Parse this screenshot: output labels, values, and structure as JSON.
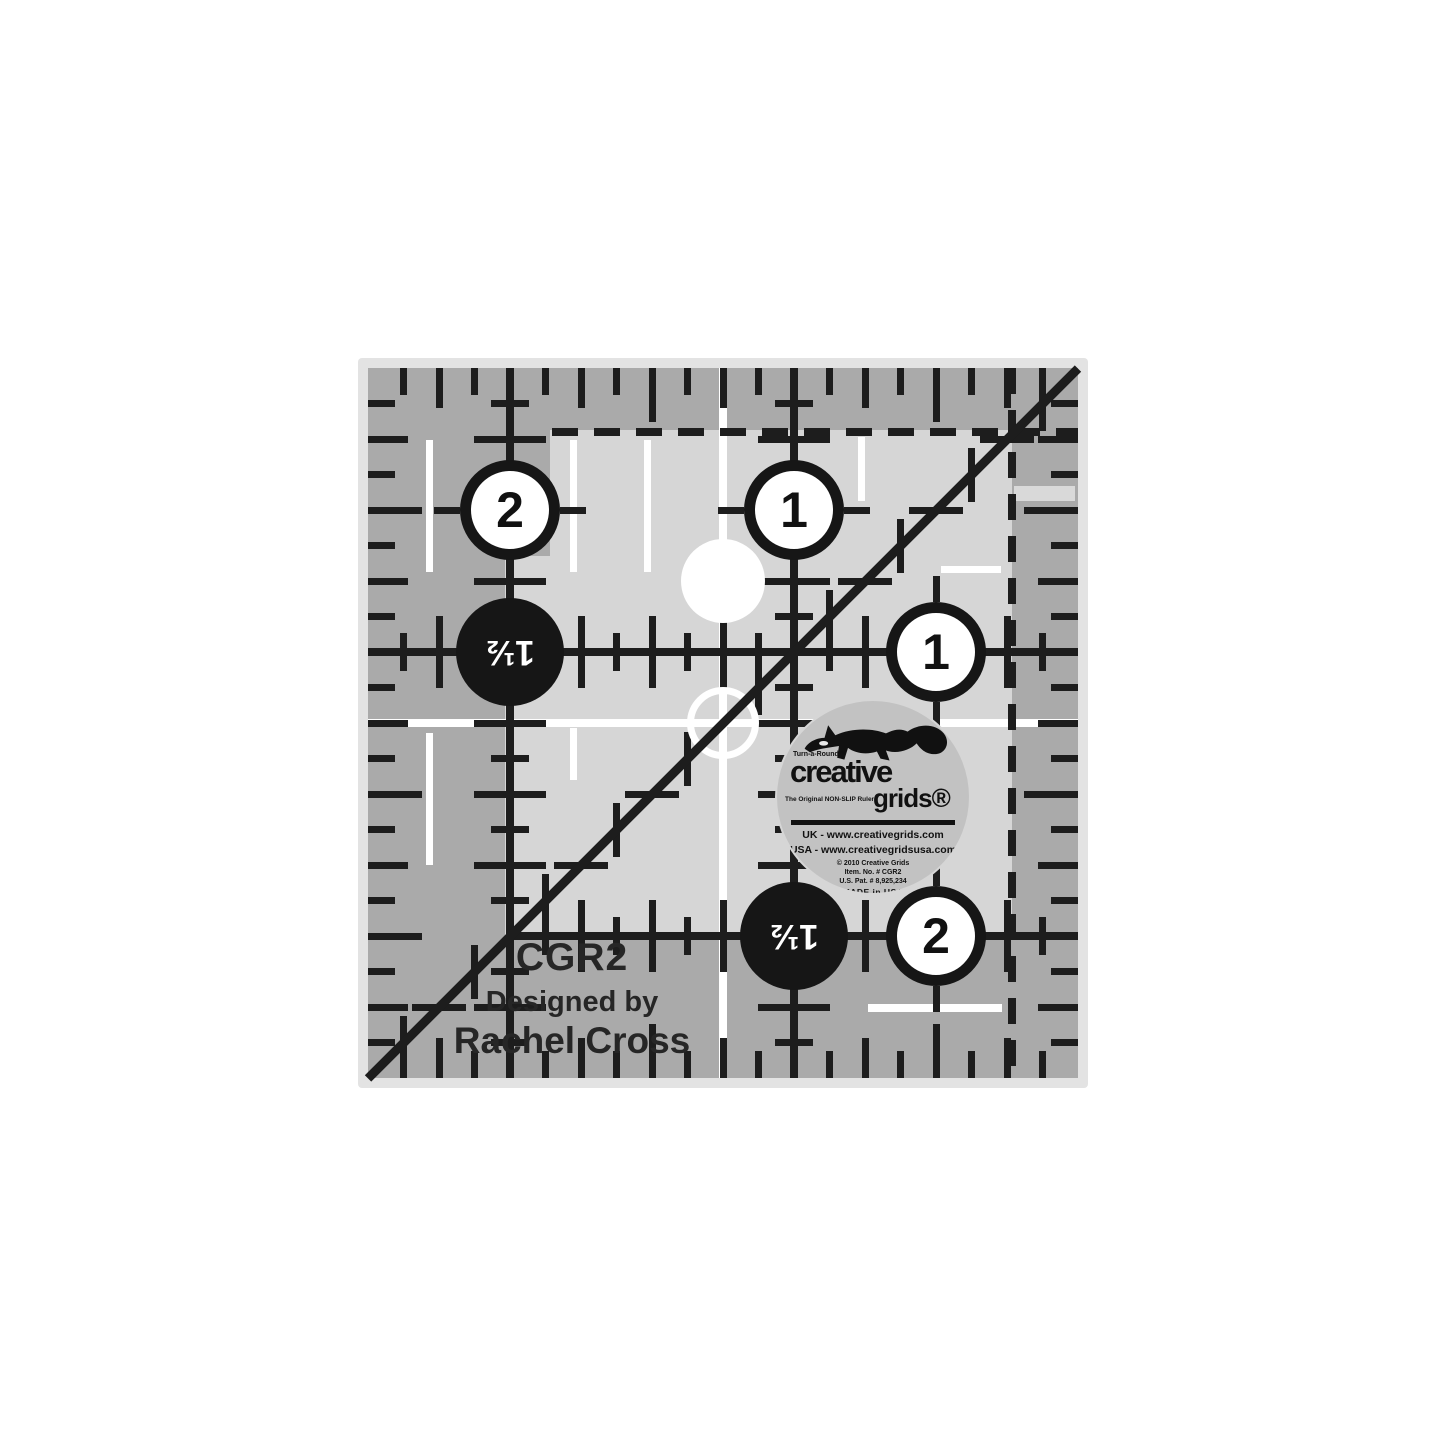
{
  "product": {
    "model": "CGR2",
    "designed_by_label": "Designed by",
    "designer": "Rachel Cross"
  },
  "ruler_markings": {
    "circles": [
      {
        "value": "2",
        "style": "white",
        "orientation": "upright"
      },
      {
        "value": "1",
        "style": "white",
        "orientation": "upright"
      },
      {
        "value": "1½",
        "style": "black",
        "orientation": "inverted"
      },
      {
        "value": "1",
        "style": "white",
        "orientation": "upright"
      },
      {
        "value": "1½",
        "style": "black",
        "orientation": "inverted"
      },
      {
        "value": "2",
        "style": "white",
        "orientation": "upright"
      }
    ]
  },
  "sticker": {
    "tagline": "Turn-a-Round™",
    "brand_word1": "creative",
    "brand_word2": "grids®",
    "sub_tagline": "The Original NON-SLIP Ruler",
    "uk_line": "UK - www.creativegrids.com",
    "usa_line": "USA - www.creativegridsusa.com",
    "copyright_line": "© 2010 Creative Grids",
    "item_line": "Item. No. # CGR2",
    "patent_line": "U.S. Pat. # 8,925,234",
    "made_in": "MADE in USA"
  },
  "colors": {
    "ink": "#1d1d1d",
    "face": "#d6d6d6",
    "band": "#aaaaaa",
    "edge": "#e3e3e3",
    "sticker": "#c2c2c2",
    "highlight": "#ffffff"
  }
}
